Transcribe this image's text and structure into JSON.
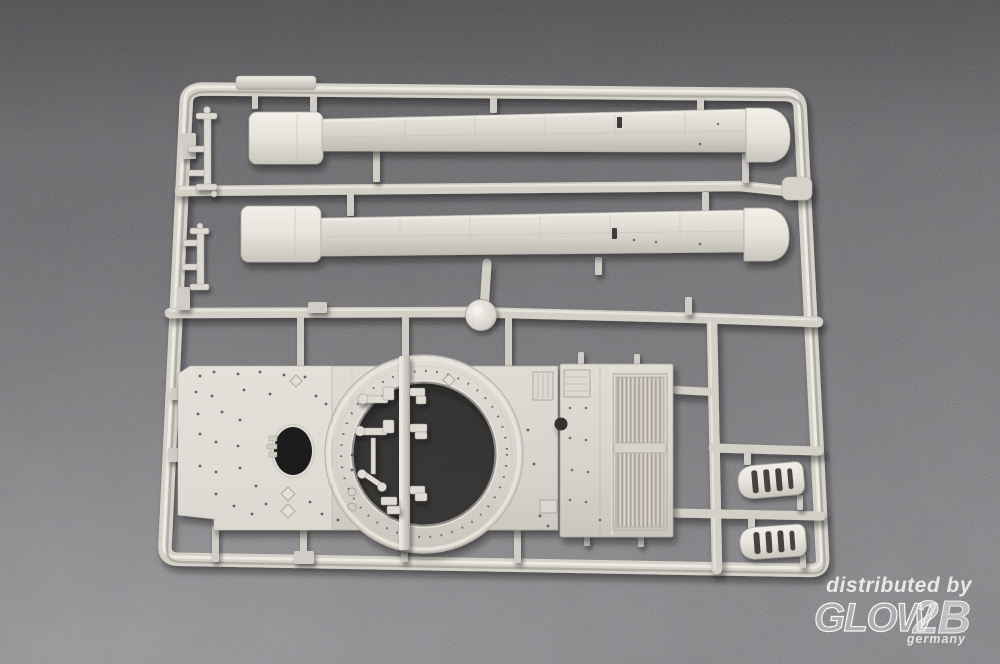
{
  "watermark": {
    "prefix": "distributed by",
    "brand": "GLOW",
    "brand_suffix": "2B",
    "country": "germany"
  },
  "colors": {
    "background_top": "#6b6a6d",
    "background_bottom": "#8e8d90",
    "plastic_highlight": "#f1eee8",
    "plastic_base": "#d7d4cc",
    "plastic_shadow": "#a6a39b",
    "cavity_dark": "#232220",
    "watermark_text": "#ffffff"
  }
}
